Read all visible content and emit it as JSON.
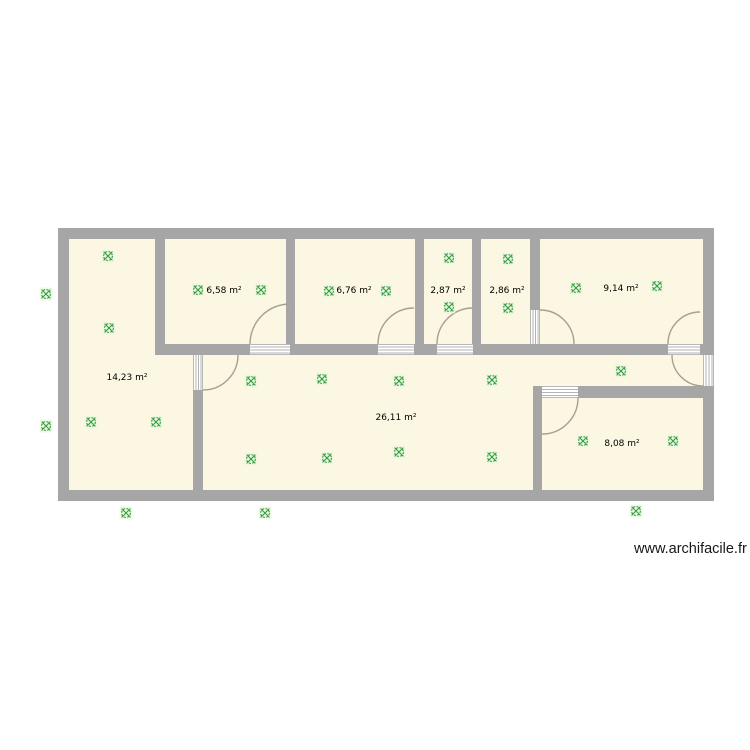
{
  "page": {
    "background": "#ffffff",
    "watermark": "www.archifacile.fr"
  },
  "palette": {
    "wall_gray": "#a6a6a6",
    "room_fill_cream": "#fbf7e2",
    "door_arc_gray": "#a89f93",
    "outlet_green": "#2f9e3c",
    "outlet_pale_bg": "#edf6e1",
    "label_black": "#000000"
  },
  "rooms": [
    {
      "id": "room-1",
      "area_label": "14,23 m²",
      "label_x": 127,
      "label_y": 377
    },
    {
      "id": "room-2",
      "area_label": "6,58 m²",
      "label_x": 224,
      "label_y": 290
    },
    {
      "id": "room-3",
      "area_label": "6,76 m²",
      "label_x": 354,
      "label_y": 290
    },
    {
      "id": "room-4",
      "area_label": "2,87 m²",
      "label_x": 448,
      "label_y": 290
    },
    {
      "id": "room-5",
      "area_label": "2,86 m²",
      "label_x": 507,
      "label_y": 290
    },
    {
      "id": "room-6",
      "area_label": "9,14 m²",
      "label_x": 621,
      "label_y": 288
    },
    {
      "id": "room-7",
      "area_label": "26,11 m²",
      "label_x": 396,
      "label_y": 417
    },
    {
      "id": "room-8",
      "area_label": "8,08 m²",
      "label_x": 622,
      "label_y": 443
    }
  ],
  "outlets": {
    "symbol": "socket-circle-x-icon",
    "color": "#2f9e3c",
    "positions": [
      [
        46,
        294
      ],
      [
        46,
        426
      ],
      [
        126,
        513
      ],
      [
        265,
        513
      ],
      [
        636,
        511
      ],
      [
        108,
        256
      ],
      [
        109,
        328
      ],
      [
        91,
        422
      ],
      [
        156,
        422
      ],
      [
        198,
        290
      ],
      [
        261,
        290
      ],
      [
        329,
        291
      ],
      [
        386,
        291
      ],
      [
        449,
        258
      ],
      [
        449,
        307
      ],
      [
        508,
        259
      ],
      [
        508,
        308
      ],
      [
        576,
        288
      ],
      [
        657,
        286
      ],
      [
        251,
        381
      ],
      [
        322,
        379
      ],
      [
        399,
        381
      ],
      [
        492,
        380
      ],
      [
        621,
        371
      ],
      [
        251,
        459
      ],
      [
        327,
        458
      ],
      [
        399,
        452
      ],
      [
        492,
        457
      ],
      [
        583,
        441
      ],
      [
        673,
        441
      ]
    ]
  }
}
